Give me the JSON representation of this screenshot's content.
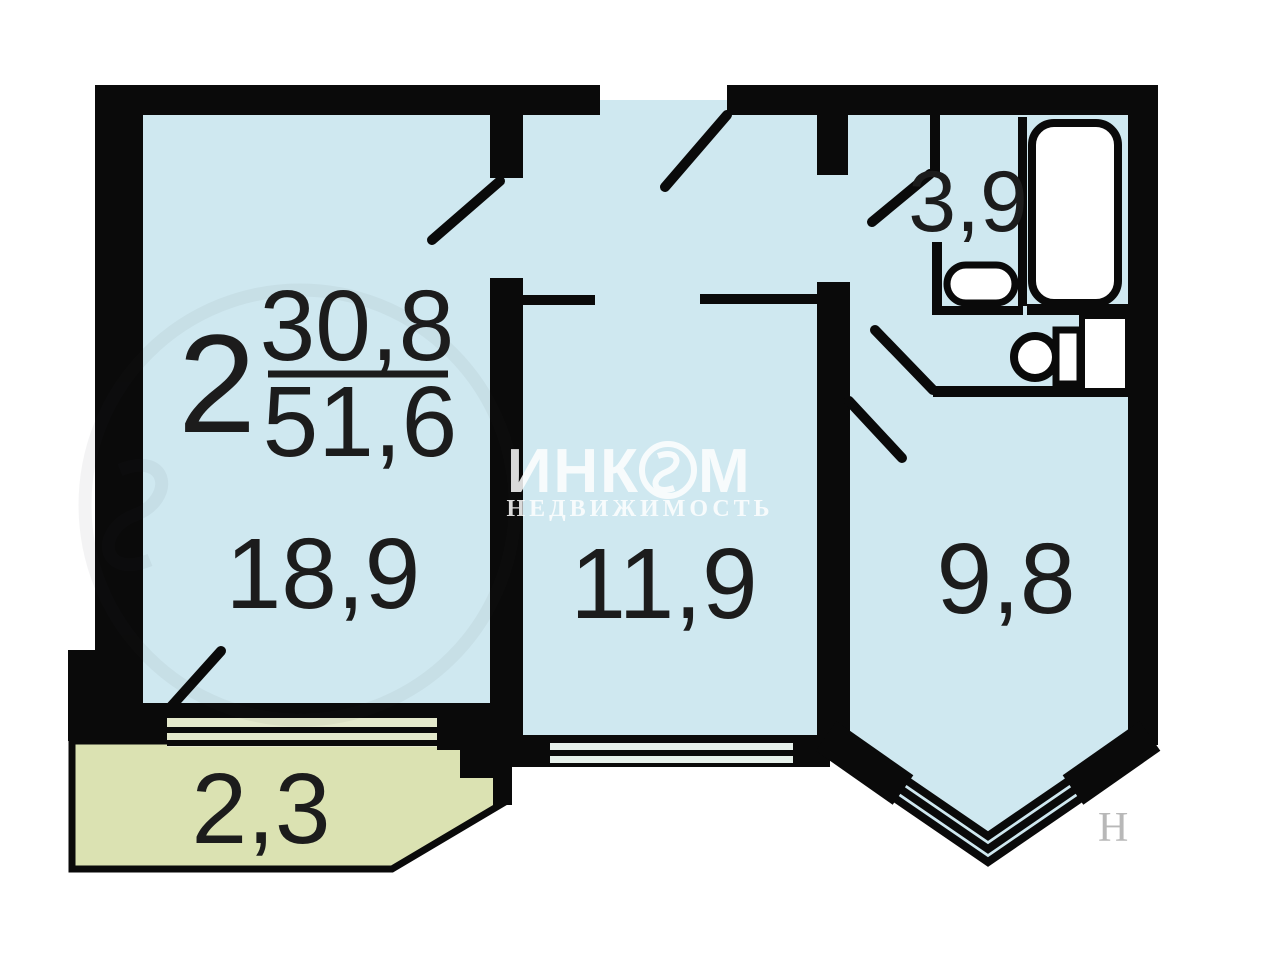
{
  "plan": {
    "title_block": {
      "rooms_count": "2",
      "living_area": "30,8",
      "total_area": "51,6"
    },
    "rooms": [
      {
        "name": "living-room",
        "area": "18,9"
      },
      {
        "name": "inner-room",
        "area": "11,9"
      },
      {
        "name": "kitchen",
        "area": "9,8"
      },
      {
        "name": "bathroom",
        "area": "3,9"
      },
      {
        "name": "balcony",
        "area": "2,3"
      }
    ],
    "watermark": {
      "brand_full": "ИНКОМ",
      "brand_left": "ИНК",
      "brand_right": "М",
      "subtitle": "НЕДВИЖИМОСТЬ",
      "corner_fragment": "Н"
    },
    "colors": {
      "wall": "#0a0a0a",
      "room_fill": "#cfe8f0",
      "balcony_fill": "#dbe2b2",
      "sill_fill": "#e4e9cc",
      "window_stripe": "#e6f0ea",
      "fixture_fill": "#ffffff",
      "label_color": "#1c1c1c"
    }
  }
}
